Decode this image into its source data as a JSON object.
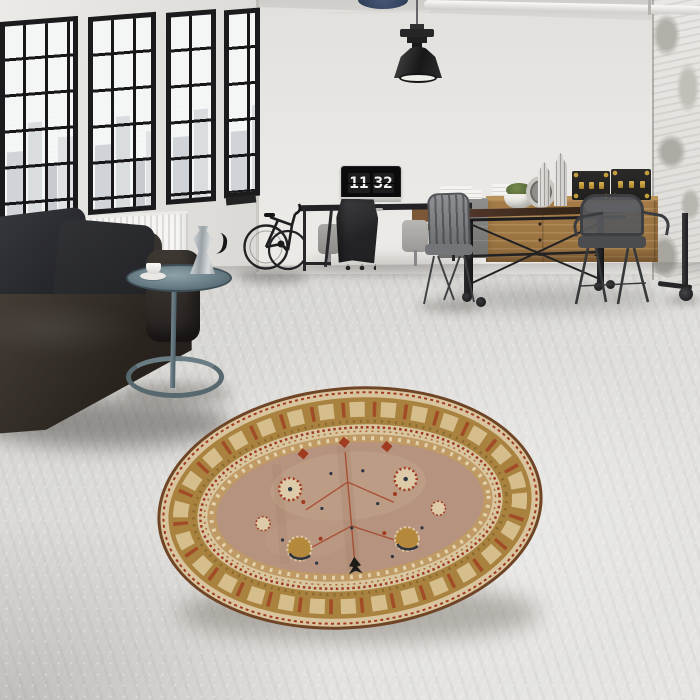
{
  "monitor_clock": {
    "hours": "11",
    "minutes": "32"
  },
  "objects": [
    "factory-windows",
    "city-skyline",
    "radiator",
    "leather-sofa",
    "cushions",
    "side-table",
    "espresso-maker",
    "coffee-cup",
    "bicycle",
    "wall-bike-rack",
    "pendant-lamp",
    "ceiling-pipe",
    "desk",
    "monitor-flip-clock",
    "office-chair",
    "coat-on-valet-stand",
    "slat-chair",
    "wood-chair",
    "industrial-dining-table",
    "metal-armchair",
    "wood-sideboard",
    "paper-stacks",
    "potted-plant",
    "lanterns",
    "round-mirror",
    "storage-trunks",
    "concrete-column",
    "round-oriental-rug"
  ],
  "palette": {
    "wall": "#eae8e4",
    "left_wall": "#eceae6",
    "window_frame": "#1b1b1d",
    "sky": "#f4f5f5",
    "skyline": "#b7bdc3",
    "sofa_leather": "#332e2a",
    "pillow": "#26272b",
    "radiator": "#f2f1ee",
    "side_table": "#5d727b",
    "lamp": "#242424",
    "desk": "#232325",
    "monitor_screen": "#0b0b0c",
    "clock_card": "#1d1d1f",
    "clock_digit": "#f5f5f4",
    "jacket": "#303032",
    "metal_chair": "#45474a",
    "wood_table_top": "#3f2d1f",
    "wood_sideboard": "#a57c48",
    "trunk": "#2b2a28",
    "brass": "#c49d3c",
    "plant": "#49592f",
    "rug_edge": "#6f4526",
    "rug_gold": "#a8823e",
    "rug_cream": "#d8c49e",
    "rug_red": "#a03a20",
    "rug_tan": "#c09a64",
    "rug_field": "#b6937e",
    "rug_navy": "#2d3442",
    "rug_black": "#1e1c18"
  }
}
